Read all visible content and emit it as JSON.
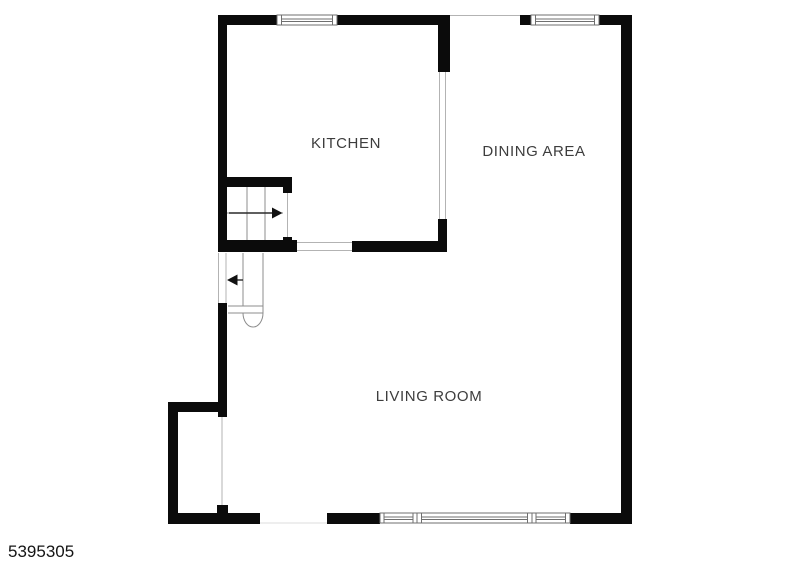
{
  "page": {
    "background_color": "#ffffff",
    "photo_id": "5395305"
  },
  "floorplan": {
    "type": "floor-plan",
    "wall_color": "#0b0b0b",
    "label_color": "#3d3d3d",
    "opening_line_color": "#b3b3b3",
    "rooms": [
      {
        "name": "kitchen",
        "label": "KITCHEN"
      },
      {
        "name": "dining-area",
        "label": "DINING AREA"
      },
      {
        "name": "living-room",
        "label": "LIVING ROOM"
      }
    ],
    "features": [
      "window-top-kitchen",
      "window-top-dining",
      "window-assembly-bottom",
      "staircase-up-with-right-arrow",
      "staircase-down-with-left-arrow",
      "entry-notch-bottom-left",
      "open-passages"
    ]
  }
}
